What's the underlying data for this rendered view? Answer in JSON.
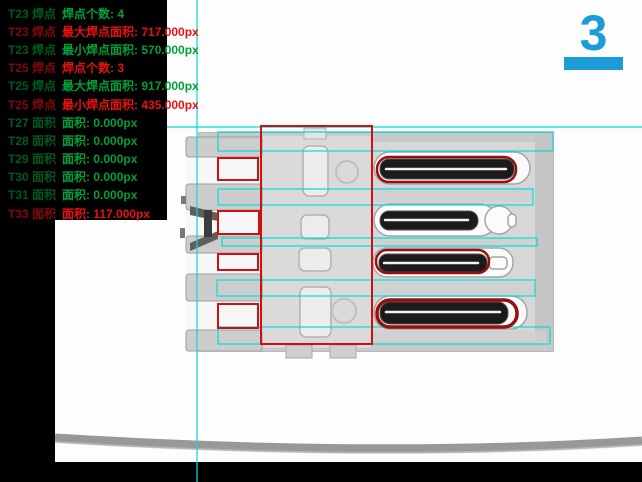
{
  "panel": {
    "rows": [
      {
        "tool": "T23 焊点",
        "text": "焊点个数: 4",
        "status": "ok"
      },
      {
        "tool": "T23 焊点",
        "text": "最大焊点面积: 717.000px",
        "status": "ng"
      },
      {
        "tool": "T23 焊点",
        "text": "最小焊点面积: 570.000px",
        "status": "ok"
      },
      {
        "tool": "T25 焊点",
        "text": "焊点个数: 3",
        "status": "ng"
      },
      {
        "tool": "T25 焊点",
        "text": "最大焊点面积: 917.000px",
        "status": "ok"
      },
      {
        "tool": "T25 焊点",
        "text": "最小焊点面积: 435.000px",
        "status": "ng"
      },
      {
        "tool": "T27 面积",
        "text": "面积: 0.000px",
        "status": "ok"
      },
      {
        "tool": "T28 面积",
        "text": "面积: 0.000px",
        "status": "ok"
      },
      {
        "tool": "T29 面积",
        "text": "面积: 0.000px",
        "status": "ok"
      },
      {
        "tool": "T30 面积",
        "text": "面积: 0.000px",
        "status": "ok"
      },
      {
        "tool": "T31 面积",
        "text": "面积: 0.000px",
        "status": "ok"
      },
      {
        "tool": "T33 面积",
        "text": "面积: 117.000px",
        "status": "ng"
      }
    ]
  },
  "counter": {
    "value": "3"
  },
  "colors": {
    "ok_green": "#00a038",
    "ng_red": "#e81010",
    "counter_blue": "#1b9cd8",
    "overlay_cyan": "#00dcdc",
    "overlay_red": "#d01010",
    "weld_outline_red": "#9b0e0e"
  },
  "overlays": {
    "crosshair": {
      "v_x": 197,
      "h_y": 127
    },
    "cyan_rects": [
      {
        "x": 218,
        "y": 132,
        "w": 335,
        "h": 19
      },
      {
        "x": 218,
        "y": 189,
        "w": 315,
        "h": 16
      },
      {
        "x": 222,
        "y": 238,
        "w": 315,
        "h": 8
      },
      {
        "x": 217,
        "y": 280,
        "w": 318,
        "h": 16
      },
      {
        "x": 218,
        "y": 327,
        "w": 332,
        "h": 17
      }
    ],
    "red_rects": [
      {
        "x": 261,
        "y": 126,
        "w": 111,
        "h": 218,
        "sw": 2
      },
      {
        "x": 218,
        "y": 158,
        "w": 40,
        "h": 22,
        "sw": 2
      },
      {
        "x": 218,
        "y": 211,
        "w": 41,
        "h": 23,
        "sw": 2
      },
      {
        "x": 218,
        "y": 254,
        "w": 40,
        "h": 16,
        "sw": 2
      },
      {
        "x": 218,
        "y": 304,
        "w": 40,
        "h": 24,
        "sw": 2
      }
    ],
    "weld_outlines": [
      {
        "x": 377,
        "y": 157,
        "w": 139,
        "h": 25,
        "r": 12,
        "sw": 2.5
      },
      {
        "x": 376,
        "y": 250,
        "w": 113,
        "h": 23,
        "r": 11,
        "sw": 2.5
      },
      {
        "x": 377,
        "y": 300,
        "w": 140,
        "h": 27,
        "r": 13,
        "sw": 3.5
      }
    ]
  }
}
